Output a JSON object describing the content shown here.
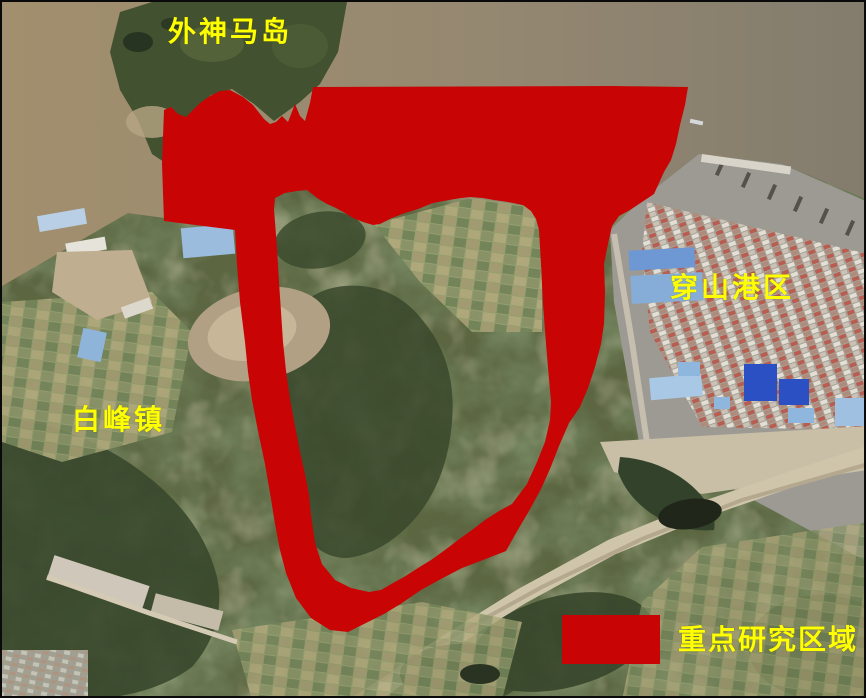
{
  "map": {
    "type": "satellite-annotation-map",
    "overlay_color": "#c80404",
    "label_color": "#ffff00",
    "labels": {
      "island": "外神马岛",
      "port": "穿山港区",
      "town": "白峰镇"
    },
    "legend": {
      "label": "重点研究区域",
      "swatch_color": "#c80404"
    }
  }
}
